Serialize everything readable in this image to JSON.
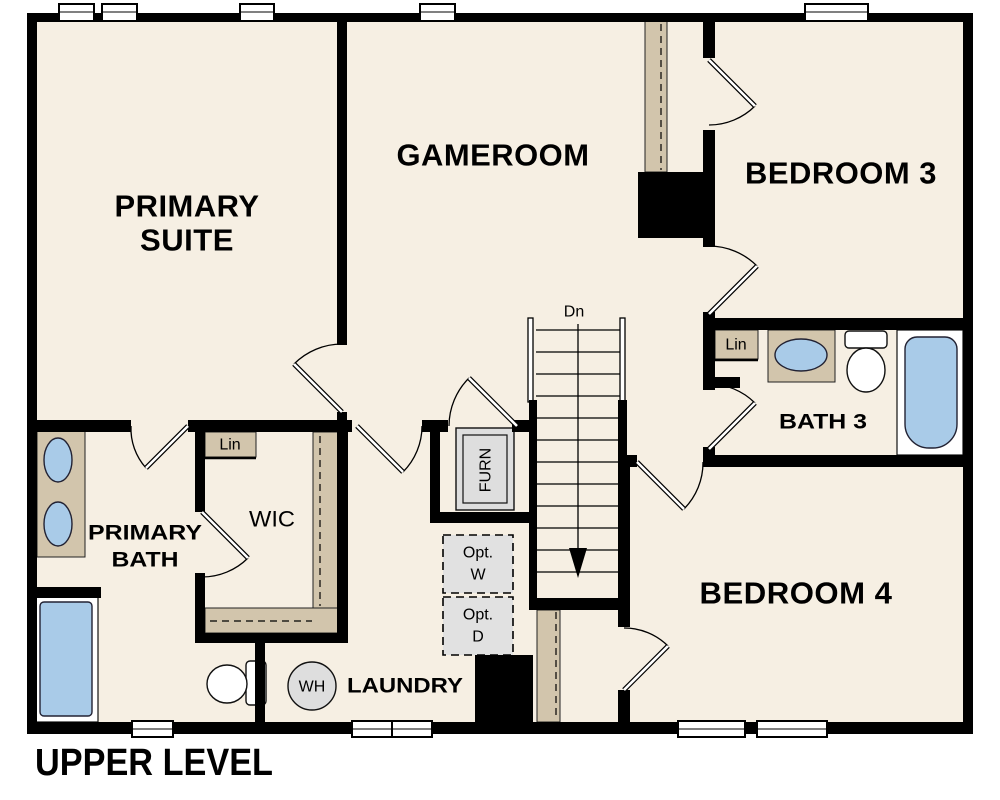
{
  "title": "UPPER LEVEL",
  "rooms": {
    "primary_suite": {
      "line1": "PRIMARY",
      "line2": "SUITE"
    },
    "gameroom": {
      "label": "GAMEROOM"
    },
    "bedroom3": {
      "label": "BEDROOM 3"
    },
    "bedroom4": {
      "label": "BEDROOM 4"
    },
    "bath3": {
      "label": "BATH 3"
    },
    "primary_bath": {
      "line1": "PRIMARY",
      "line2": "BATH"
    },
    "wic": {
      "label": "WIC"
    },
    "laundry": {
      "label": "LAUNDRY"
    }
  },
  "callouts": {
    "stairs_direction": "Dn",
    "linen_wic": "Lin",
    "linen_bath3": "Lin",
    "water_heater": "WH",
    "furnace": "FURN",
    "optional_washer": {
      "line1": "Opt.",
      "line2": "W"
    },
    "optional_dryer": {
      "line1": "Opt.",
      "line2": "D"
    }
  },
  "colors": {
    "floor": "#f6efe3",
    "wall": "#000000",
    "casework_tan": "#d2c5ac",
    "fixture_blue": "#a9cbe8",
    "equipment_gray": "#dedede",
    "page_background": "#ffffff"
  }
}
